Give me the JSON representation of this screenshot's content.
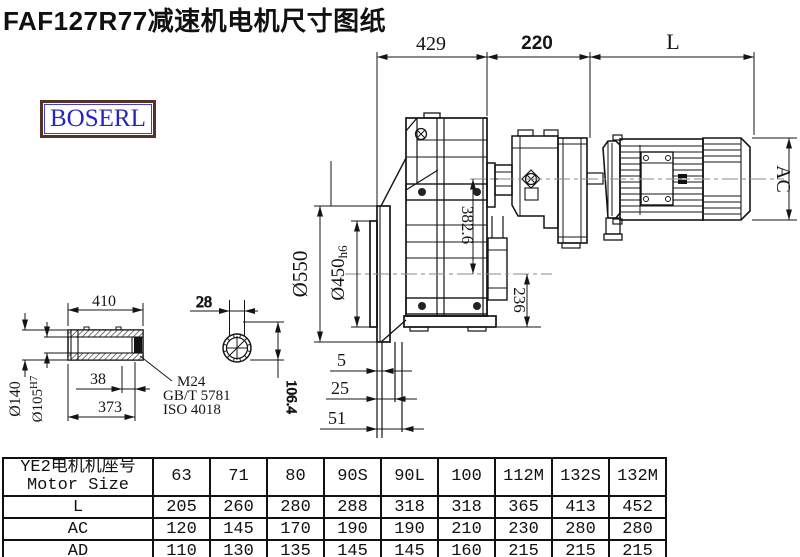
{
  "page": {
    "title": "FAF127R77减速机电机尺寸图纸"
  },
  "logo": {
    "text": "BOSERL"
  },
  "drawing": {
    "dims": {
      "d429": "429",
      "d220": "220",
      "dL": "L",
      "dAC": "AC",
      "d382_6": "382.6",
      "d236": "236",
      "d550": "Ø550",
      "d450": "Ø450",
      "d450_tol": "h6",
      "d5": "5",
      "d25": "25",
      "d51": "51",
      "d410": "410",
      "d140": "Ø140",
      "d105": "Ø105",
      "d105_tol": "H7",
      "d38": "38",
      "d373": "373",
      "d28": "28",
      "d106_4": "106.4"
    },
    "notes": {
      "thread": "M24",
      "standard_gb": "GB/T 5781",
      "standard_iso": "ISO 4018"
    }
  },
  "table": {
    "header": {
      "cn": "YE2电机机座号",
      "en": "Motor Size"
    },
    "columns": [
      "63",
      "71",
      "80",
      "90S",
      "90L",
      "100",
      "112M",
      "132S",
      "132M"
    ],
    "rows": [
      {
        "label": "L",
        "values": [
          "205",
          "260",
          "280",
          "288",
          "318",
          "318",
          "365",
          "413",
          "452"
        ]
      },
      {
        "label": "AC",
        "values": [
          "120",
          "145",
          "170",
          "190",
          "190",
          "210",
          "230",
          "280",
          "280"
        ]
      },
      {
        "label": "AD",
        "values": [
          "110",
          "130",
          "135",
          "145",
          "145",
          "160",
          "215",
          "215",
          "215"
        ]
      }
    ]
  }
}
